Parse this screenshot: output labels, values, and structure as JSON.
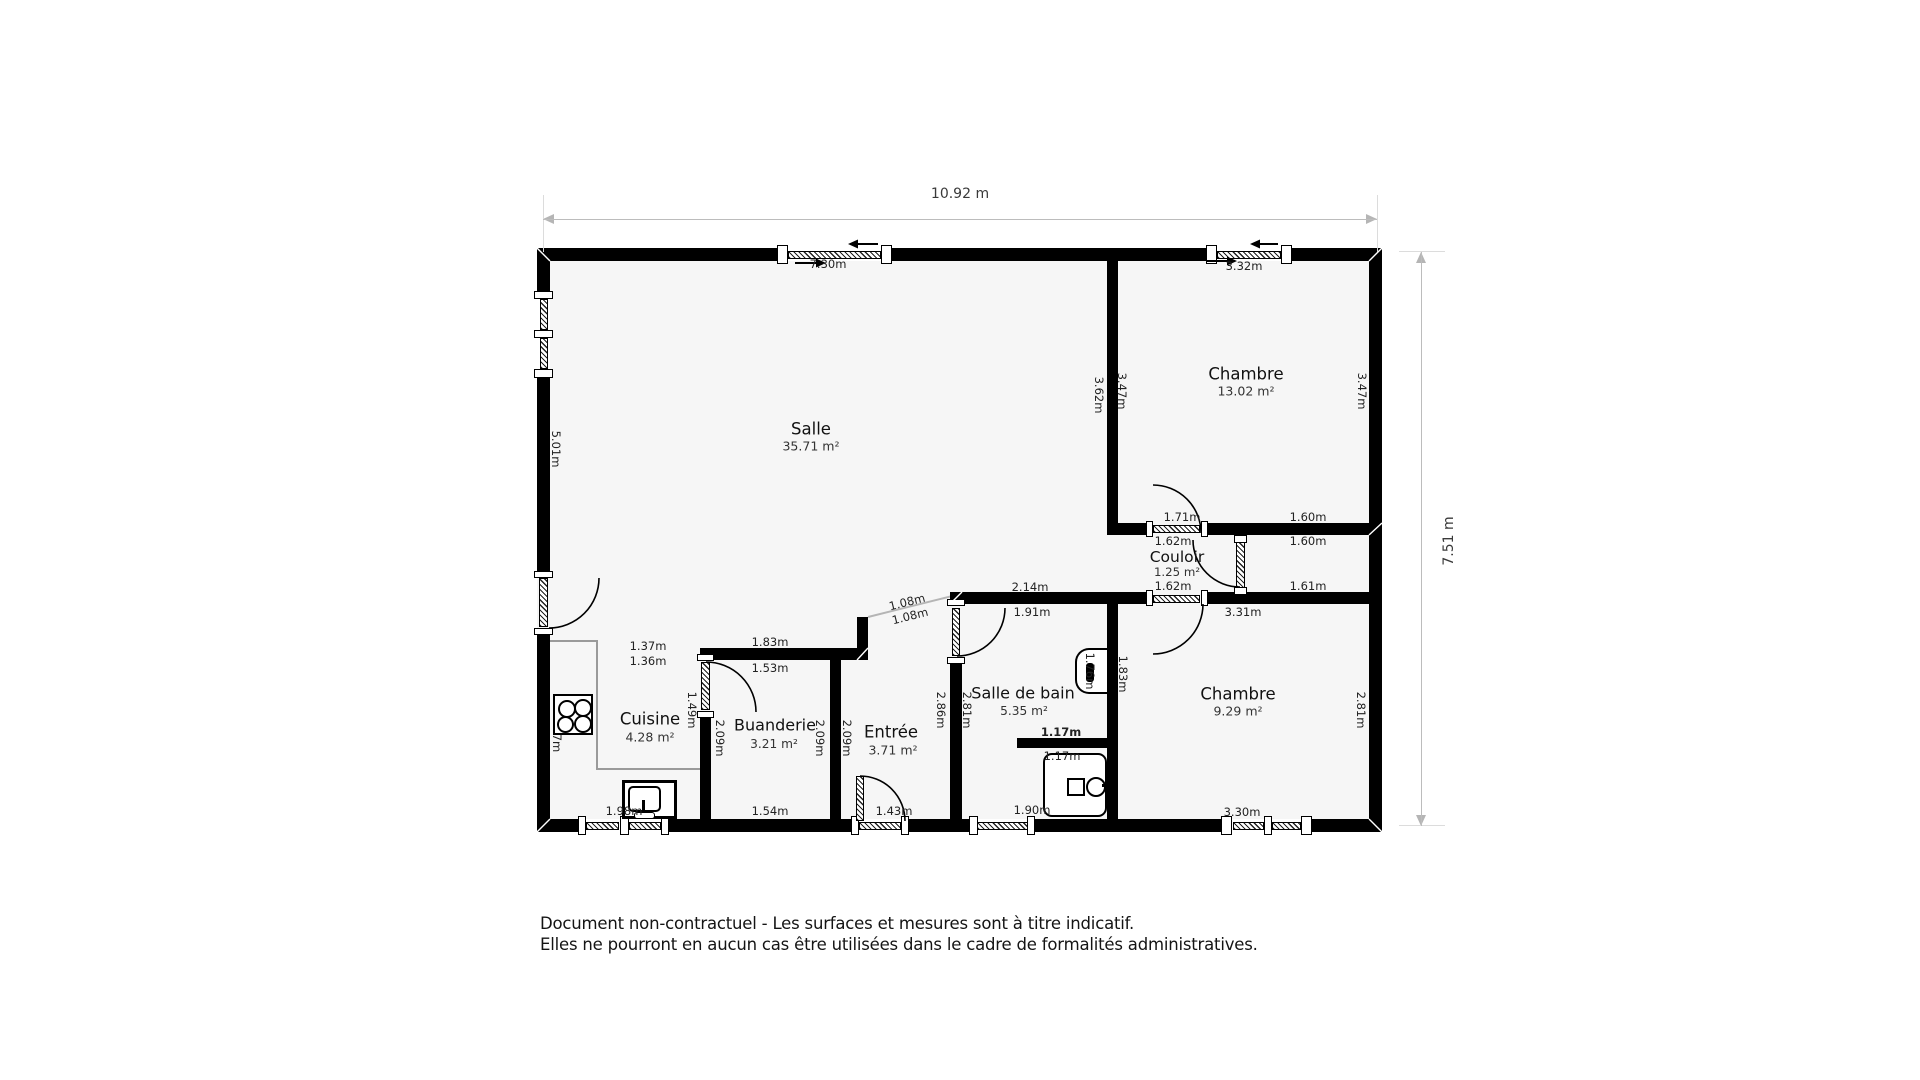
{
  "title": "Plan d'appartement",
  "dimensions": {
    "width_label": "10.92 m",
    "height_label": "7.51 m"
  },
  "disclaimer": {
    "line1": "Document non-contractuel - Les surfaces et mesures sont à titre indicatif.",
    "line2": "Elles ne pourront en aucun cas être utilisées dans le cadre de formalités administratives."
  },
  "colors": {
    "wall": "#000000",
    "floor": "#f6f6f6",
    "dimension_line": "#bcbcbc",
    "text": "#222222"
  },
  "fixture_icons": [
    "stove-icon",
    "sink-icon",
    "toilet-icon",
    "shower-icon"
  ],
  "rooms": [
    {
      "name": "Salle",
      "area": "35.71 m²",
      "nx": 811,
      "ny": 429,
      "ax": 811,
      "ay": 446,
      "size": 16.5
    },
    {
      "name": "Chambre",
      "area": "13.02 m²",
      "nx": 1246,
      "ny": 374,
      "ax": 1246,
      "ay": 391,
      "size": 16.5
    },
    {
      "name": "Couloir",
      "area": "1.25 m²",
      "nx": 1177,
      "ny": 557,
      "ax": 1177,
      "ay": 572,
      "size": 15.5
    },
    {
      "name": "Cuisine",
      "area": "4.28 m²",
      "nx": 650,
      "ny": 719,
      "ax": 650,
      "ay": 737,
      "size": 16.5
    },
    {
      "name": "Buanderie",
      "area": "3.21 m²",
      "nx": 775,
      "ny": 725,
      "ax": 774,
      "ay": 744,
      "size": 16
    },
    {
      "name": "Entrée",
      "area": "3.71 m²",
      "nx": 891,
      "ny": 732,
      "ax": 893,
      "ay": 750,
      "size": 16.5
    },
    {
      "name": "Salle de bain",
      "area": "5.35 m²",
      "nx": 1023,
      "ny": 693,
      "ax": 1024,
      "ay": 711,
      "size": 16
    },
    {
      "name": "Chambre",
      "area": "9.29 m²",
      "nx": 1238,
      "ny": 694,
      "ax": 1238,
      "ay": 711,
      "size": 16.5
    }
  ],
  "measurements": [
    {
      "text": "7.30m",
      "x": 828,
      "y": 264,
      "rot": 0
    },
    {
      "text": "3.32m",
      "x": 1244,
      "y": 266,
      "rot": 0
    },
    {
      "text": "1.71m",
      "x": 1182,
      "y": 517,
      "rot": 0
    },
    {
      "text": "1.60m",
      "x": 1308,
      "y": 517,
      "rot": 0
    },
    {
      "text": "1.62m",
      "x": 1173,
      "y": 541,
      "rot": 0
    },
    {
      "text": "1.60m",
      "x": 1308,
      "y": 541,
      "rot": 0
    },
    {
      "text": "1.62m",
      "x": 1173,
      "y": 586,
      "rot": 0
    },
    {
      "text": "1.61m",
      "x": 1308,
      "y": 586,
      "rot": 0
    },
    {
      "text": "3.31m",
      "x": 1243,
      "y": 612,
      "rot": 0
    },
    {
      "text": "2.14m",
      "x": 1030,
      "y": 587,
      "rot": 0
    },
    {
      "text": "1.91m",
      "x": 1032,
      "y": 612,
      "rot": 0
    },
    {
      "text": "1.83m",
      "x": 770,
      "y": 642,
      "rot": 0
    },
    {
      "text": "1.53m",
      "x": 770,
      "y": 668,
      "rot": 0
    },
    {
      "text": "1.37m",
      "x": 648,
      "y": 646,
      "rot": 0
    },
    {
      "text": "1.36m",
      "x": 648,
      "y": 661,
      "rot": 0
    },
    {
      "text": "1.17m",
      "x": 1061,
      "y": 732,
      "rot": 0,
      "bold": true
    },
    {
      "text": "1.17m",
      "x": 1062,
      "y": 756,
      "rot": 0
    },
    {
      "text": "1.90m",
      "x": 1032,
      "y": 810,
      "rot": 0
    },
    {
      "text": "3.30m",
      "x": 1242,
      "y": 812,
      "rot": 0
    },
    {
      "text": "1.54m",
      "x": 770,
      "y": 811,
      "rot": 0
    },
    {
      "text": "1.43m",
      "x": 894,
      "y": 811,
      "rot": 0
    },
    {
      "text": "1.98m",
      "x": 624,
      "y": 811,
      "rot": 0
    },
    {
      "text": "1.08m",
      "x": 907,
      "y": 602,
      "rot": -14
    },
    {
      "text": "1.08m",
      "x": 910,
      "y": 616,
      "rot": -14
    },
    {
      "text": "5.01m",
      "x": 556,
      "y": 449,
      "rot": 90
    },
    {
      "text": "3.62m",
      "x": 1099,
      "y": 395,
      "rot": 90
    },
    {
      "text": "3.47m",
      "x": 1122,
      "y": 391,
      "rot": 90
    },
    {
      "text": "3.47m",
      "x": 1362,
      "y": 391,
      "rot": 90
    },
    {
      "text": "1.49m",
      "x": 692,
      "y": 710,
      "rot": 90
    },
    {
      "text": "2.09m",
      "x": 720,
      "y": 738,
      "rot": 90
    },
    {
      "text": "2.09m",
      "x": 820,
      "y": 738,
      "rot": 90
    },
    {
      "text": "2.09m",
      "x": 847,
      "y": 738,
      "rot": 90
    },
    {
      "text": "2.86m",
      "x": 941,
      "y": 710,
      "rot": 90
    },
    {
      "text": "2.81m",
      "x": 967,
      "y": 710,
      "rot": 90
    },
    {
      "text": "1.83m",
      "x": 1123,
      "y": 674,
      "rot": 90
    },
    {
      "text": "1.76m",
      "x": 1090,
      "y": 671,
      "rot": 90
    },
    {
      "text": "2.81m",
      "x": 1361,
      "y": 710,
      "rot": 90
    },
    {
      "text": "7m",
      "x": 557,
      "y": 743,
      "rot": 90
    }
  ]
}
